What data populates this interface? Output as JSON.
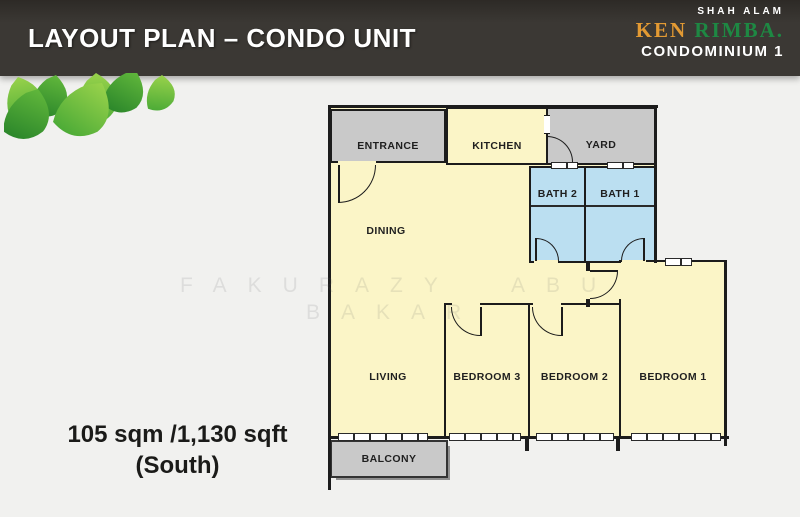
{
  "header": {
    "title": "LAYOUT PLAN – CONDO UNIT",
    "bg_color": "#3B3834",
    "text_color": "#FFFFFF"
  },
  "brand": {
    "location": "SHAH ALAM",
    "name_ken": "KEN",
    "name_rimba": "RIMBA.",
    "subtitle": "CONDOMINIUM 1",
    "ken_color": "#E39A33",
    "rimba_color": "#1E8843",
    "text_color": "#FFFFFF"
  },
  "watermark": {
    "line1": "FAKURAZY  ABU",
    "line2": "BAKAR"
  },
  "area_label": {
    "line1": "105 sqm /1,130 sqft",
    "line2": "(South)"
  },
  "floorplan": {
    "colors": {
      "floor": "#FBF5C7",
      "service_rooms": "#C9C9C9",
      "bathrooms": "#BBDFF1",
      "walls": "#1C1C1C",
      "background": "#F1F1EF"
    },
    "rooms": {
      "entrance": "ENTRANCE",
      "kitchen": "KITCHEN",
      "yard": "YARD",
      "bath2": "BATH 2",
      "bath1": "BATH 1",
      "dining": "DINING",
      "living": "LIVING",
      "bedroom3": "BEDROOM 3",
      "bedroom2": "BEDROOM 2",
      "bedroom1": "BEDROOM 1",
      "balcony": "BALCONY"
    }
  }
}
